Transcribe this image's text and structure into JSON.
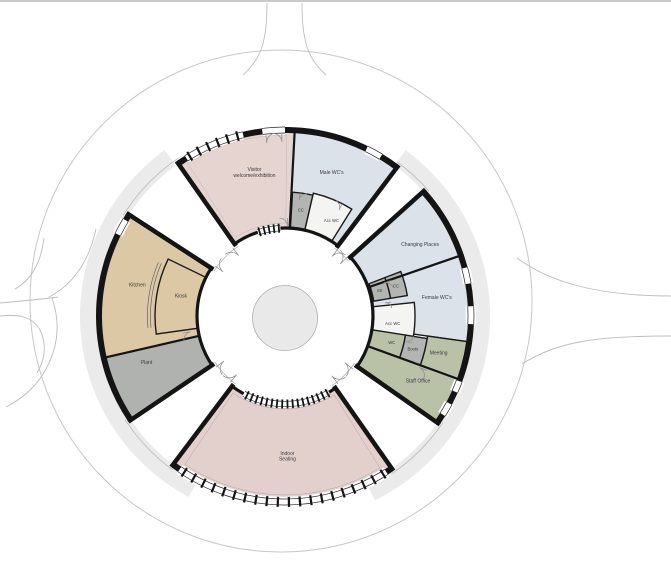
{
  "plan": {
    "title": "Circular building floor plan",
    "rooms": {
      "visitor": {
        "label": "Visitor welcome/exhibition",
        "lines": [
          "Visitor",
          "welcome/exhibition"
        ],
        "color": "#e6d4d1"
      },
      "male_wcs": {
        "label": "Male WC's",
        "lines": [
          "Male WC's"
        ],
        "color": "#dce2ea"
      },
      "cc_top": {
        "label": "CC",
        "lines": [
          "CC"
        ],
        "color": "#b3b5b2"
      },
      "acc_wc_top": {
        "label": "Acc WC",
        "lines": [
          "Acc WC"
        ],
        "color": "#f4f4f2"
      },
      "changing_places": {
        "label": "Changing Places",
        "lines": [
          "Changing Places"
        ],
        "color": "#dce2ea"
      },
      "female_wcs": {
        "label": "Female WC's",
        "lines": [
          "Female WC's"
        ],
        "color": "#dce2ea"
      },
      "str": {
        "label": "Str",
        "lines": [
          "Str"
        ],
        "color": "#b3b5b2"
      },
      "cc_right": {
        "label": "CC",
        "lines": [
          "CC"
        ],
        "color": "#b3b5b2"
      },
      "acc_wc_right": {
        "label": "Acc WC",
        "lines": [
          "Acc WC"
        ],
        "color": "#f4f4f2"
      },
      "wc": {
        "label": "WC",
        "lines": [
          "WC"
        ],
        "color": "#b9c1a7"
      },
      "boots": {
        "label": "Boots",
        "lines": [
          "Boots"
        ],
        "color": "#b3b5b2"
      },
      "meeting": {
        "label": "Meeting",
        "lines": [
          "Meeting"
        ],
        "color": "#b9c1a7"
      },
      "staff_office": {
        "label": "Staff Office",
        "lines": [
          "Staff Office"
        ],
        "color": "#b9c1a7"
      },
      "indoor_seating": {
        "label": "Indoor Seating",
        "lines": [
          "Indoor",
          "Seating"
        ],
        "color": "#e3d0cd"
      },
      "kitchen": {
        "label": "Kitchen",
        "lines": [
          "Kitchen"
        ],
        "color": "#ddc8a6"
      },
      "kiosk": {
        "label": "Kiosk",
        "lines": [
          "Kiosk"
        ],
        "color": "#ddc8a6"
      },
      "plant": {
        "label": "Plant",
        "lines": [
          "Plant"
        ],
        "color": "#b0b2b0"
      }
    },
    "colors": {
      "wall": "#141414",
      "site_boundary": "#c8c8c8",
      "road": "#bdbdbd",
      "shadow_band": "#ebebeb",
      "centre_circle_fill": "#e9e9e9",
      "centre_circle_stroke": "#adadad",
      "top_border": "#c9c9c9",
      "label_text": "#3a3a3a",
      "pink_room": "#e6d4d1",
      "blue_room": "#dce2ea",
      "green_room": "#b9c1a7",
      "tan_room": "#ddc8a6",
      "grey_room": "#b3b5b2",
      "white_room": "#f4f4f2"
    }
  }
}
